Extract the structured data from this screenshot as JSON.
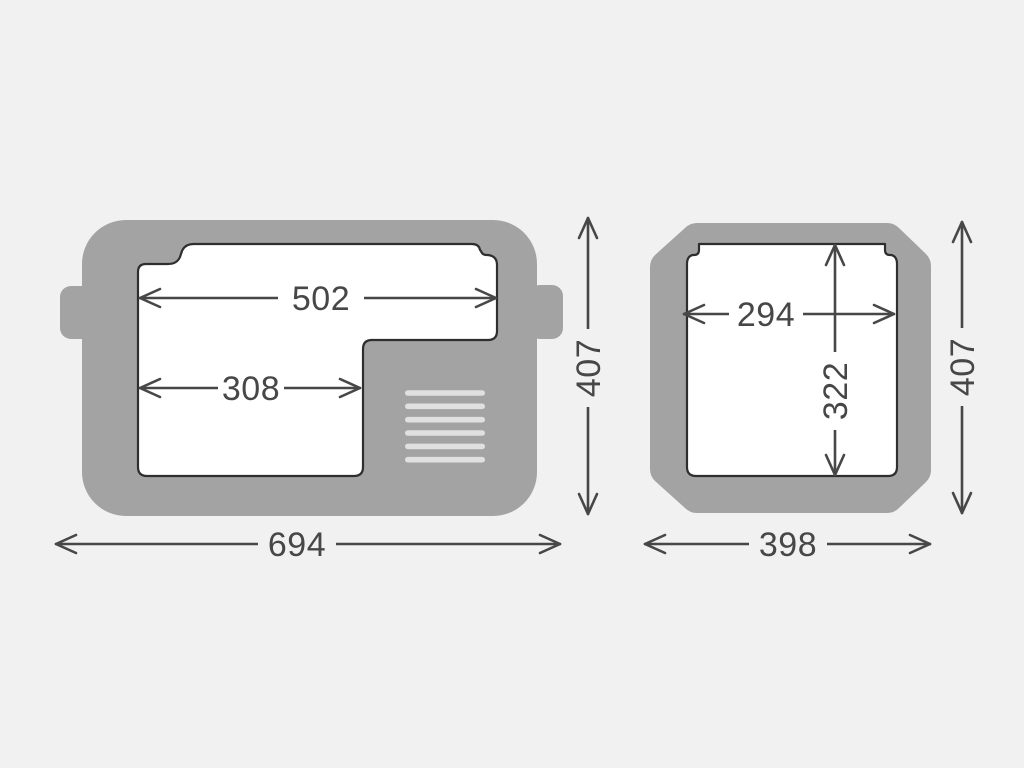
{
  "colors": {
    "background": "#f1f1f2",
    "body": "#a3a3a3",
    "interior": "#ffffff",
    "outline": "#2e2e2e",
    "vent": "#e0e0e0",
    "dimension": "#474747"
  },
  "side_view": {
    "dims": {
      "lid_opening_width": "502",
      "compartment_width": "308",
      "overall_width": "694",
      "overall_height": "407"
    },
    "vent_slats": 6
  },
  "end_view": {
    "dims": {
      "inner_width": "294",
      "inner_depth": "322",
      "overall_width": "398",
      "overall_height": "407"
    }
  }
}
